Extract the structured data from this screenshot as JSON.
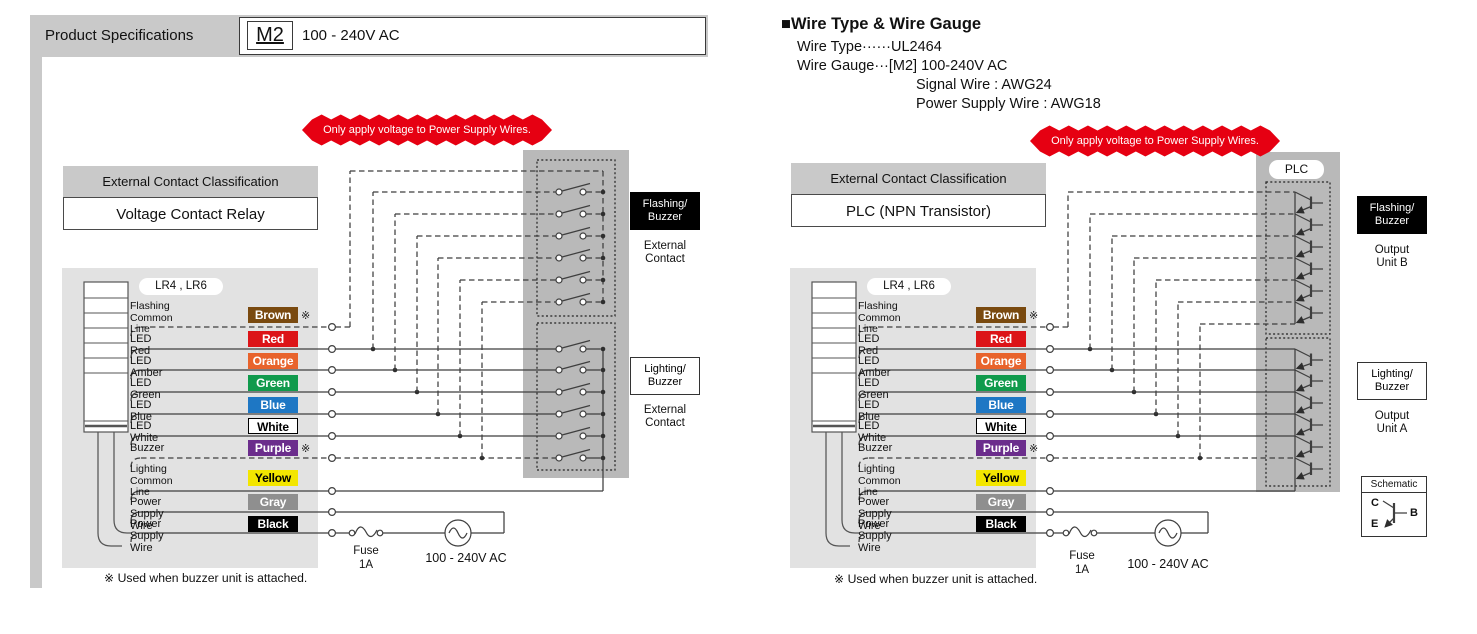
{
  "header": {
    "title": "Product Specifications",
    "model_badge": "M2",
    "model_voltage": "100 - 240V AC"
  },
  "wire_info": {
    "heading": "■Wire Type & Wire Gauge",
    "lines": [
      "Wire Type······UL2464",
      "Wire Gauge···[M2] 100-240V AC",
      "Signal Wire : AWG24",
      "Power Supply Wire : AWG18"
    ]
  },
  "warning_banner": "Only apply voltage to Power Supply Wires.",
  "tower_model": "LR4 , LR6",
  "note": "※ Used when buzzer unit is attached.",
  "power_source": {
    "fuse_label": "Fuse",
    "fuse_rating": "1A",
    "voltage_label": "100 - 240V AC"
  },
  "wires": [
    {
      "label": "Flashing\nCommon Line",
      "color_name": "Brown",
      "hex": "#7A4A10",
      "text_color": "#ffffff",
      "dashed": true,
      "marker": "※"
    },
    {
      "label": "LED Red",
      "color_name": "Red",
      "hex": "#DC1418",
      "text_color": "#ffffff",
      "dashed": false,
      "marker": ""
    },
    {
      "label": "LED Amber",
      "color_name": "Orange",
      "hex": "#E8632C",
      "text_color": "#ffffff",
      "dashed": false,
      "marker": ""
    },
    {
      "label": "LED Green",
      "color_name": "Green",
      "hex": "#109A4C",
      "text_color": "#ffffff",
      "dashed": false,
      "marker": ""
    },
    {
      "label": "LED Blue",
      "color_name": "Blue",
      "hex": "#1E77C4",
      "text_color": "#ffffff",
      "dashed": false,
      "marker": ""
    },
    {
      "label": "LED White",
      "color_name": "White",
      "hex": "#FFFFFF",
      "text_color": "#000000",
      "dashed": false,
      "marker": ""
    },
    {
      "label": "Buzzer",
      "color_name": "Purple",
      "hex": "#6B2D8C",
      "text_color": "#ffffff",
      "dashed": true,
      "marker": "※"
    },
    {
      "label": "Lighting\nCommon Line",
      "color_name": "Yellow",
      "hex": "#F3E600",
      "text_color": "#000000",
      "dashed": false,
      "marker": ""
    },
    {
      "label": "Power Supply Wire",
      "color_name": "Gray",
      "hex": "#8F8F8F",
      "text_color": "#ffffff",
      "dashed": false,
      "marker": ""
    },
    {
      "label": "Power Supply Wire",
      "color_name": "Black",
      "hex": "#000000",
      "text_color": "#ffffff",
      "dashed": false,
      "marker": ""
    }
  ],
  "diagrams": [
    {
      "classification_title": "External Contact Classification",
      "classification_value": "Voltage Contact Relay",
      "top_label": "Flashing/\nBuzzer",
      "top_sub": "External\nContact",
      "bottom_label": "Lighting/\nBuzzer",
      "bottom_sub": "External\nContact"
    },
    {
      "classification_title": "External Contact Classification",
      "classification_value": "PLC (NPN Transistor)",
      "plc_label": "PLC",
      "top_label": "Flashing/\nBuzzer",
      "top_sub": "Output\nUnit B",
      "bottom_label": "Lighting/\nBuzzer",
      "bottom_sub": "Output\nUnit A",
      "schematic": {
        "title": "Schematic",
        "pin_c": "C",
        "pin_b": "B",
        "pin_e": "E"
      }
    }
  ]
}
